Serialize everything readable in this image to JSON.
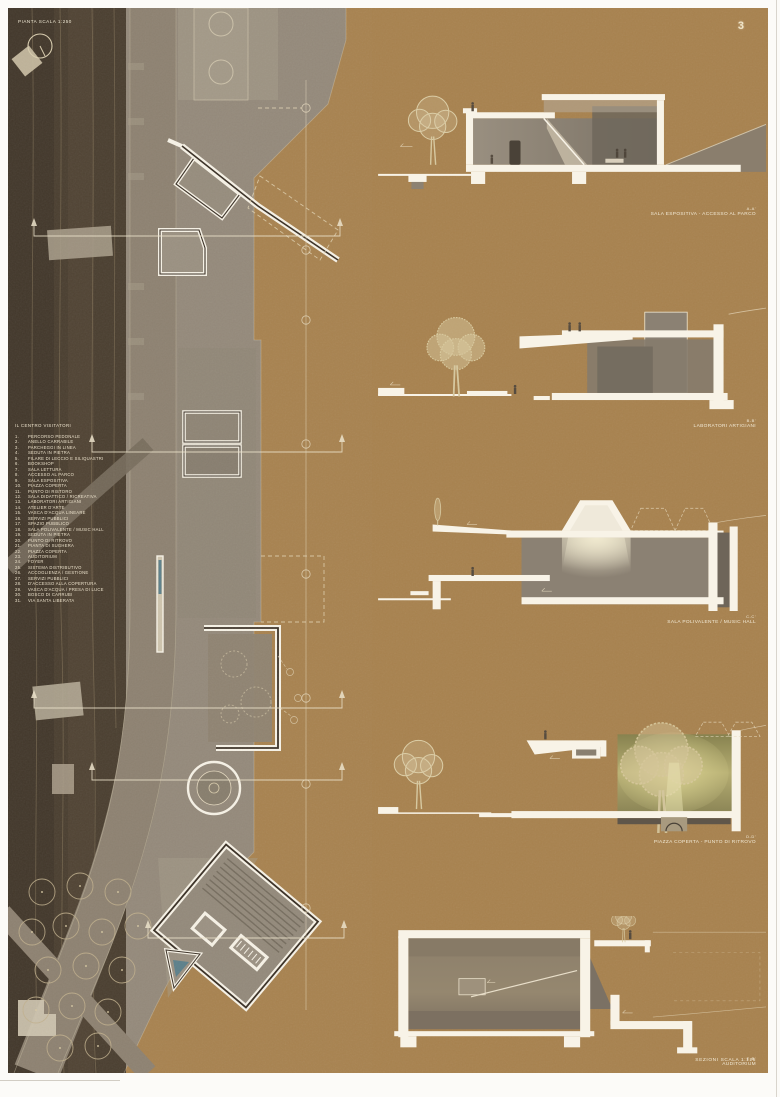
{
  "sheet": {
    "page_number": "3",
    "plan_title": "PIANTA SCALA 1:250",
    "sections_scale_label": "SEZIONI SCALA 1:125"
  },
  "legend": {
    "title": "IL CENTRO VISITATORI",
    "items": [
      {
        "num": "1.",
        "label": "PERCORSO PEDONALE"
      },
      {
        "num": "2.",
        "label": "ANELLO CARRABILE"
      },
      {
        "num": "3.",
        "label": "PARCHEGGI IN LINEA"
      },
      {
        "num": "4.",
        "label": "SEDUTA IN PIETRA"
      },
      {
        "num": "5.",
        "label": "FILARE DI LECCIO E SILIQUASTRI"
      },
      {
        "num": "6.",
        "label": "BOOKSHOP"
      },
      {
        "num": "7.",
        "label": "SALA LETTURA"
      },
      {
        "num": "8.",
        "label": "ACCESSO AL PARCO"
      },
      {
        "num": "9.",
        "label": "SALA ESPOSITIVA"
      },
      {
        "num": "10.",
        "label": "PIAZZA COPERTA"
      },
      {
        "num": "11.",
        "label": "PUNTO DI RISTORO"
      },
      {
        "num": "12.",
        "label": "SALA DIDATTICO / RICREATIVA"
      },
      {
        "num": "13.",
        "label": "LABORATORI ARTIGIANI"
      },
      {
        "num": "14.",
        "label": "ATELIER D'ARTE"
      },
      {
        "num": "15.",
        "label": "VASCA D'ACQUA LINEARE"
      },
      {
        "num": "16.",
        "label": "SERVIZI PUBBLICI"
      },
      {
        "num": "17.",
        "label": "SPAZIO PUBBLICO"
      },
      {
        "num": "18.",
        "label": "SALA POLIVALENTE / MUSIC HALL"
      },
      {
        "num": "19.",
        "label": "SEDUTA IN PIETRA"
      },
      {
        "num": "20.",
        "label": "PUNTO DI RITROVO"
      },
      {
        "num": "21.",
        "label": "PIANTA DI SUGHERA"
      },
      {
        "num": "22.",
        "label": "PIAZZA COPERTA"
      },
      {
        "num": "23.",
        "label": "AUDITORIUM"
      },
      {
        "num": "24.",
        "label": "FOYER"
      },
      {
        "num": "25.",
        "label": "SISTEMA DISTRIBUTIVO"
      },
      {
        "num": "26.",
        "label": "ACCOGLIENZA / GESTIONE"
      },
      {
        "num": "27.",
        "label": "SERVIZI PUBBLICI"
      },
      {
        "num": "28.",
        "label": "D'ACCESSO ALLA COPERTURA"
      },
      {
        "num": "29.",
        "label": "VASCA D'ACQUA / PRESA DI LUCE"
      },
      {
        "num": "30.",
        "label": "BOSCO DI CARRUBI"
      },
      {
        "num": "31.",
        "label": "VIA SANTA LIBERATA"
      }
    ]
  },
  "sections": [
    {
      "id": "A-A'",
      "caption": "SALA ESPOSITIVA - ACCESSO AL PARCO"
    },
    {
      "id": "B-B'",
      "caption": "LABORATORI ARTIGIANI"
    },
    {
      "id": "C-C'",
      "caption": "SALA POLIVALENTE / MUSIC HALL"
    },
    {
      "id": "D-D'",
      "caption": "PIAZZA COPERTA - PUNTO DI RITROVO"
    },
    {
      "id": "E-E'",
      "caption": "AUDITORIUM"
    }
  ],
  "colors": {
    "board": "#a8824e",
    "terrain_dark": "#493d2e",
    "road": "#8d8170",
    "piazza": "#94897a",
    "cut_white": "#f8f3e7",
    "line_cream": "#e8dcc0",
    "water_blue": "#5b7f8a"
  }
}
